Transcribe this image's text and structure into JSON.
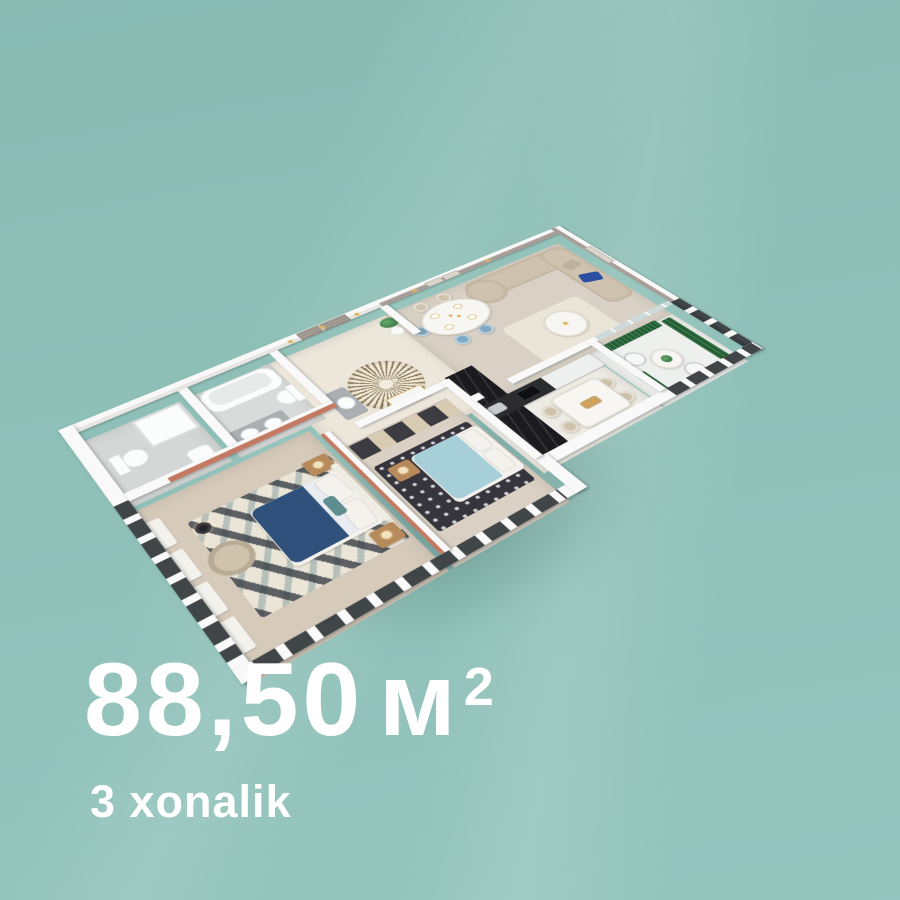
{
  "caption": {
    "area_value": "88,50",
    "area_unit": "м",
    "area_sup": "2",
    "subtitle": "3 xonalik"
  },
  "floorplan": {
    "type": "apartment-3d-floorplan-render",
    "rooms": [
      "entrance-hall",
      "bathroom",
      "bathroom-2",
      "master-bedroom",
      "bedroom-2",
      "kitchen-dining",
      "living-dining-room",
      "balcony"
    ]
  },
  "palette": {
    "bg": "#8fc2ba",
    "text": "#ffffff",
    "shadow": "rgba(30,65,62,0.30)",
    "wall": "#f8f9f8",
    "wallShade": "#e7e6e2",
    "taupe": "#a89e97",
    "salmon": "#c47a62",
    "floorHall": "#ece6db",
    "floorLiving": "#d9d1c5",
    "floorMaster": "#d6cabb",
    "floorBed2": "#dad0c3",
    "floorKitchen": "#edebe4",
    "floorBalcony": "#eef0ee",
    "tileA": "#d3d7d6",
    "tileB": "#d8dbda",
    "marble": "#1b1a1e",
    "rugLight": "#ebe5d8",
    "rugDark": "#36343d",
    "sunbrown": "#8d7a5e",
    "bedBlue": "#30517b",
    "bed2Blue": "#a7cfd9",
    "linen": "#f4f2ec",
    "cream": "#f1e3c2",
    "sofa": "#cfc2ae",
    "pillowBlue": "#2b4ea0",
    "pillowTaupe": "#beb29c",
    "chairBlue": "#7fa9c3",
    "chairCream": "#cfc3ad",
    "tableWhite": "#f7f6f2",
    "wood": "#b68a5a",
    "door": "#9a9289",
    "gold": "#d9b25e",
    "plant": "#3e7c4a",
    "planter": "#245c36",
    "glass": "#ccdadc",
    "glassDark": "#2c3134",
    "wire": "#c6cac8",
    "counter": "#a9afb2"
  }
}
